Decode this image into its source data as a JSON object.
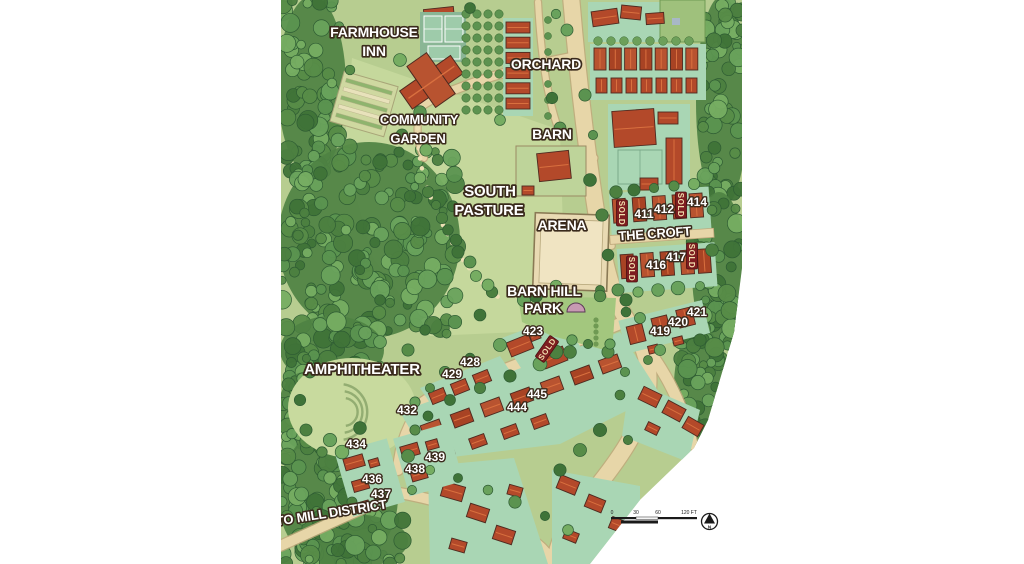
{
  "map": {
    "region_labels": [
      {
        "text": "FARMHOUSE",
        "x": 374,
        "y": 37,
        "size": 14,
        "rotate": 0
      },
      {
        "text": "INN",
        "x": 374,
        "y": 56,
        "size": 14,
        "rotate": 0
      },
      {
        "text": "ORCHARD",
        "x": 546,
        "y": 69,
        "size": 14,
        "rotate": 0
      },
      {
        "text": "COMMUNITY",
        "x": 419,
        "y": 124,
        "size": 13,
        "rotate": 0
      },
      {
        "text": "GARDEN",
        "x": 418,
        "y": 143,
        "size": 13,
        "rotate": 0
      },
      {
        "text": "BARN",
        "x": 552,
        "y": 139,
        "size": 14,
        "rotate": 0
      },
      {
        "text": "SOUTH",
        "x": 490,
        "y": 196,
        "size": 15,
        "rotate": 0
      },
      {
        "text": "PASTURE",
        "x": 489,
        "y": 215,
        "size": 15,
        "rotate": 0
      },
      {
        "text": "ARENA",
        "x": 562,
        "y": 230,
        "size": 14,
        "rotate": 0
      },
      {
        "text": "THE CROFT",
        "x": 655,
        "y": 238,
        "size": 13,
        "rotate": -4
      },
      {
        "text": "BARN HILL",
        "x": 544,
        "y": 296,
        "size": 14,
        "rotate": 0
      },
      {
        "text": "PARK",
        "x": 543,
        "y": 313,
        "size": 14,
        "rotate": 0
      },
      {
        "text": "AMPHITHEATER",
        "x": 362,
        "y": 374,
        "size": 15,
        "rotate": 0
      },
      {
        "text": "TO MILL DISTRICT",
        "x": 332,
        "y": 517,
        "size": 13,
        "rotate": -9
      }
    ],
    "lot_labels": [
      {
        "text": "411",
        "x": 644,
        "y": 218
      },
      {
        "text": "412",
        "x": 664,
        "y": 213
      },
      {
        "text": "414",
        "x": 697,
        "y": 206
      },
      {
        "text": "416",
        "x": 656,
        "y": 269
      },
      {
        "text": "417",
        "x": 676,
        "y": 261
      },
      {
        "text": "419",
        "x": 660,
        "y": 335
      },
      {
        "text": "420",
        "x": 678,
        "y": 326
      },
      {
        "text": "421",
        "x": 697,
        "y": 316
      },
      {
        "text": "423",
        "x": 533,
        "y": 335
      },
      {
        "text": "428",
        "x": 470,
        "y": 366
      },
      {
        "text": "429",
        "x": 452,
        "y": 378
      },
      {
        "text": "432",
        "x": 407,
        "y": 414
      },
      {
        "text": "434",
        "x": 356,
        "y": 448
      },
      {
        "text": "436",
        "x": 372,
        "y": 483
      },
      {
        "text": "437",
        "x": 381,
        "y": 498
      },
      {
        "text": "438",
        "x": 415,
        "y": 473
      },
      {
        "text": "439",
        "x": 435,
        "y": 461
      },
      {
        "text": "444",
        "x": 517,
        "y": 411
      },
      {
        "text": "445",
        "x": 537,
        "y": 398
      }
    ],
    "sold_markers": [
      {
        "text": "SOLD",
        "x": 622,
        "y": 213,
        "rotate": 90
      },
      {
        "text": "SOLD",
        "x": 681,
        "y": 205,
        "rotate": 90
      },
      {
        "text": "SOLD",
        "x": 632,
        "y": 269,
        "rotate": 90
      },
      {
        "text": "SOLD",
        "x": 692,
        "y": 256,
        "rotate": 90
      },
      {
        "text": "SOLD",
        "x": 547,
        "y": 349,
        "rotate": -55
      }
    ],
    "scale_bar": {
      "ticks": [
        {
          "label": "0",
          "x": 612
        },
        {
          "label": "30",
          "x": 636
        },
        {
          "label": "60",
          "x": 658
        },
        {
          "label": "120 FT",
          "x": 689
        }
      ]
    },
    "compass": {
      "label": "N"
    },
    "colors": {
      "label_fill": "#ffffff",
      "label_outline": "#3a2a1c",
      "sold_bg": "#7d1d20",
      "sold_text": "#f2dfae",
      "road": "#e7d6a8",
      "roof": "#b3492a",
      "lot_green": "#a9d6b4",
      "lawn": "#b7cd90",
      "forest": "#4c8040",
      "arena_sand": "#e9dab3"
    }
  }
}
